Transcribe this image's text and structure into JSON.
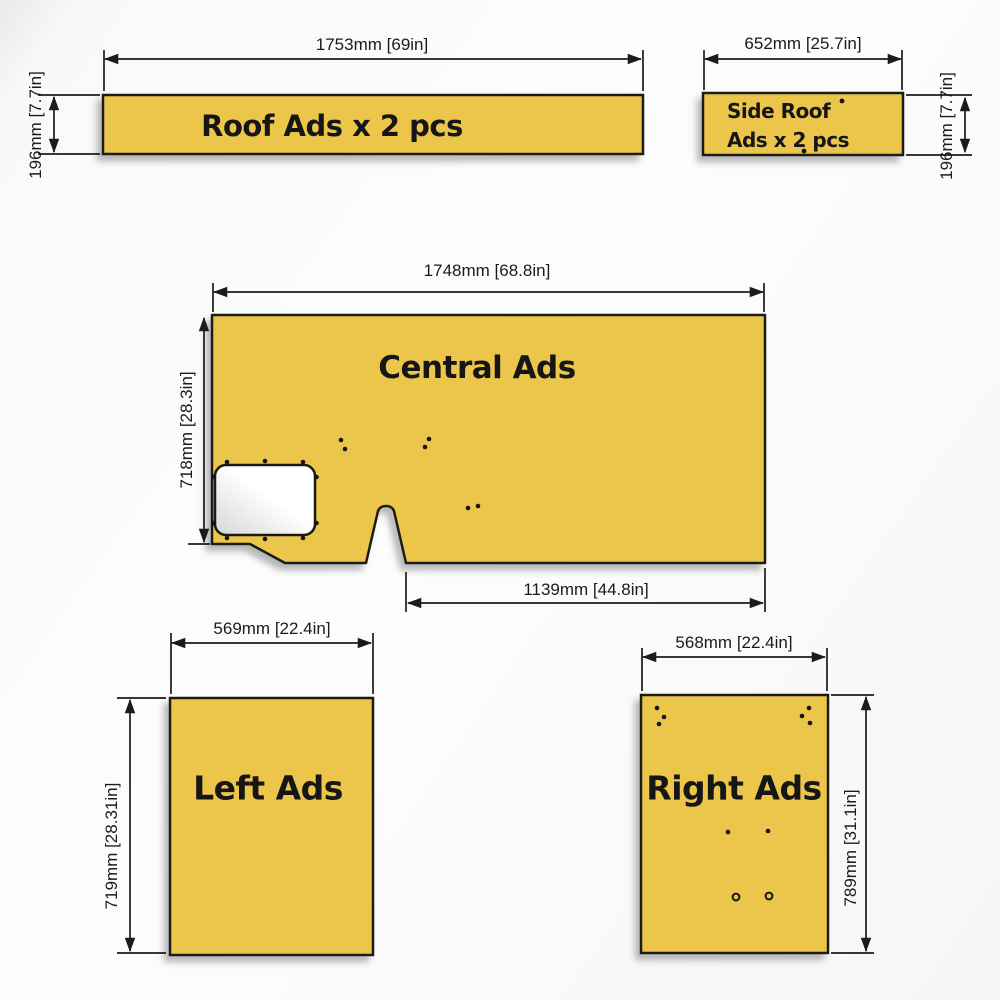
{
  "colors": {
    "panel_fill": "#ebc64c",
    "panel_border": "#1a1a12",
    "dim_line": "#1b1b1b",
    "hole_fill": "#141414",
    "cutout_shade_from": "#ffffff",
    "cutout_shade_to": "#d6d6d6"
  },
  "panels": {
    "roof": {
      "name": "Roof Ads x 2 pcs",
      "width_dim": "1753mm [69in]",
      "height_dim": "196mm [7.7in]"
    },
    "side_roof": {
      "name_line1": "Side Roof",
      "name_line2": "Ads x 2 pcs",
      "width_dim": "652mm [25.7in]",
      "height_dim": "196mm [7.7in]"
    },
    "central": {
      "name": "Central Ads",
      "width_dim": "1748mm [68.8in]",
      "height_dim": "718mm [28.3in]",
      "lower_width_dim": "1139mm [44.8in]"
    },
    "left": {
      "name": "Left Ads",
      "width_dim": "569mm [22.4in]",
      "height_dim": "719mm [28.31in]"
    },
    "right": {
      "name": "Right Ads",
      "width_dim": "568mm [22.4in]",
      "height_dim": "789mm [31.1in]"
    }
  }
}
